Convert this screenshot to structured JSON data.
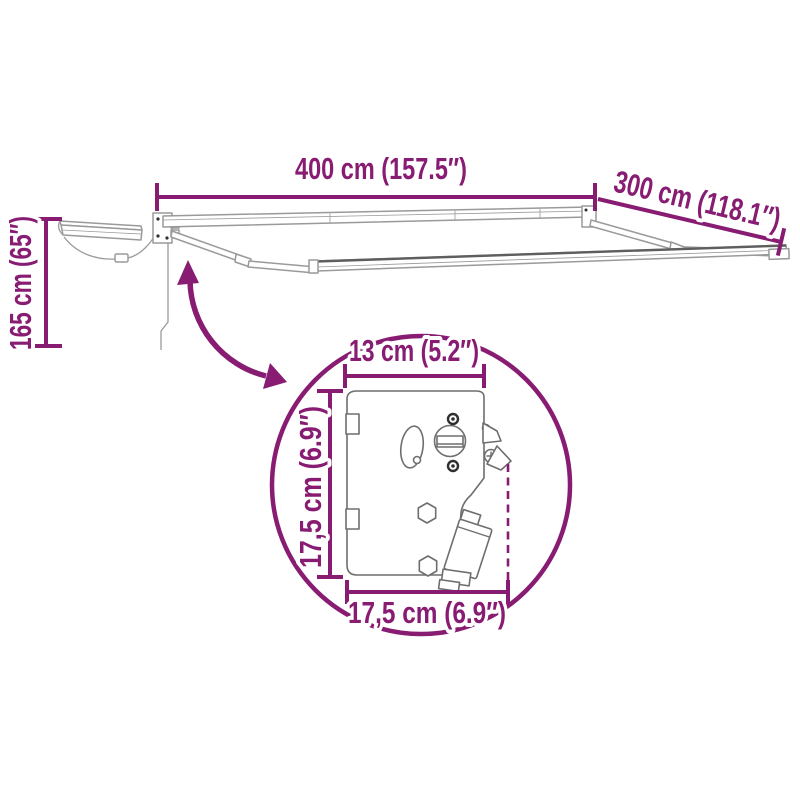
{
  "colors": {
    "accent": "#871C72",
    "sketch": "#9a9a9a",
    "background": "#ffffff"
  },
  "overall_dimensions": {
    "width_label": "400 cm (157.5″)",
    "depth_label": "300 cm (118.1″)",
    "height_label": "165 cm (65″)"
  },
  "detail_callout": {
    "bracket_width_label": "13 cm (5.2″)",
    "bracket_height_label": "17,5 cm (6.9″)",
    "bracket_depth_label": "17,5 cm (6.9″)"
  },
  "icons": {
    "rotation_arrow": "curved-double-arrow"
  }
}
